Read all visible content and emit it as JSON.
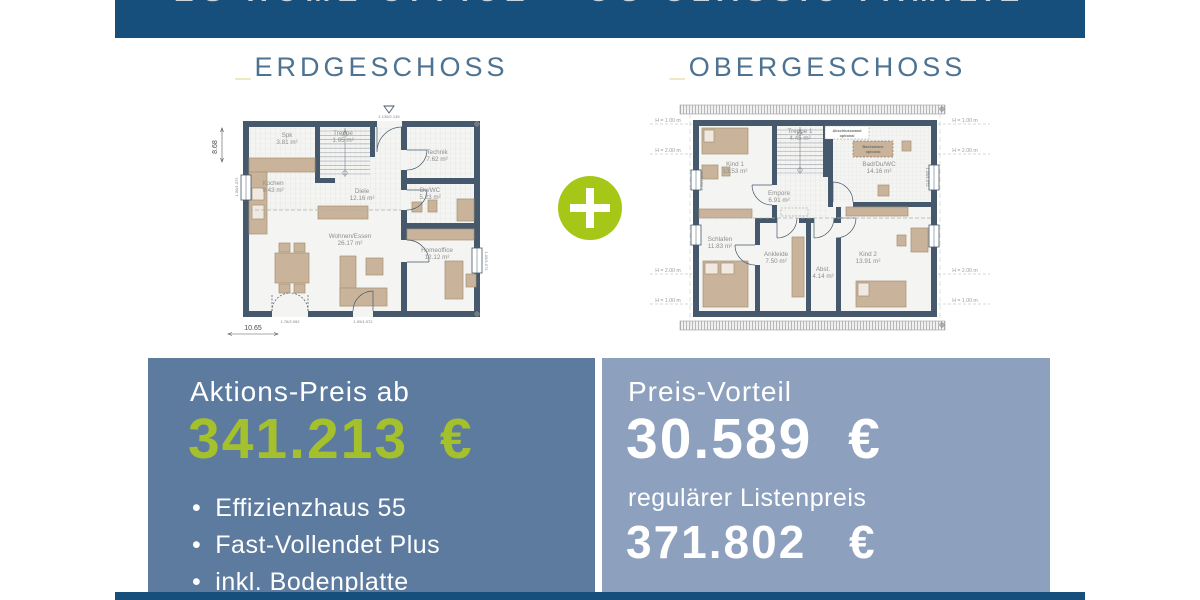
{
  "banner": {
    "title": "EG HOME OFFICE + OG CLASSIC FAMILIE"
  },
  "headings": {
    "underscore": "_",
    "eg_label": "ERDGESCHOSS",
    "og_label": "OBERGESCHOSS"
  },
  "colors": {
    "navy": "#164e7c",
    "box_left": "#5d7b9e",
    "box_right": "#8da0bd",
    "accent_green": "#a6c717",
    "price_green": "#a4c02c",
    "wall": "#46586b"
  },
  "eg": {
    "rooms": {
      "spk": {
        "name": "Spk",
        "area": "3.81 m²"
      },
      "treppe": {
        "name": "Treppe",
        "area": "1.95 m²"
      },
      "technik": {
        "name": "Technik",
        "area": "7.62 m²"
      },
      "kochen": {
        "name": "Kochen",
        "area": "9.43 m²"
      },
      "diele": {
        "name": "Diele",
        "area": "12.16 m²"
      },
      "duwc": {
        "name": "Du/WC",
        "area": "5.23 m²"
      },
      "wohnen": {
        "name": "Wohnen/Essen",
        "area": "26.17 m²"
      },
      "homeoffice": {
        "name": "Homeoffice",
        "area": "12.12 m²"
      }
    },
    "dim_width": "10.65",
    "dim_height": "8.68",
    "entry_size": "1.135/2.135",
    "terrace_door_size": "1.76/2.092",
    "patio_door_size": "1.09/1.072",
    "window_left_size": "1.00/1.072",
    "window_right_size": "1.09/1.072"
  },
  "og": {
    "rooms": {
      "kind1": {
        "name": "Kind 1",
        "area": "13.53 m²"
      },
      "treppe1": {
        "name": "Treppe 1",
        "area": "4.45 m²"
      },
      "bad": {
        "name": "Bad/Du/WC",
        "area": "14.16 m²"
      },
      "empore": {
        "name": "Empore",
        "area": "6.91 m²"
      },
      "schlafen": {
        "name": "Schlafen",
        "area": "11.83 m²"
      },
      "ankleide": {
        "name": "Ankleide",
        "area": "7.50 m²"
      },
      "abst": {
        "name": "Abst.",
        "area": "4.14 m²"
      },
      "kind2": {
        "name": "Kind 2",
        "area": "13.91 m²"
      }
    },
    "note_wall_1": "Abschlusswand",
    "note_wall_2": "optional",
    "note_tub_1": "Badewanne",
    "note_tub_2": "optional",
    "h_low": "H = 1.00 m",
    "h_high": "H = 2.00 m",
    "window_left_size": "1.00/1.072",
    "window_right_size": "1.09/1.072"
  },
  "offer": {
    "label": "Aktions-Preis ab",
    "price": "341.213 €",
    "bullets": [
      "Effizienzhaus 55",
      "Fast-Vollendet Plus",
      "inkl. Bodenplatte"
    ]
  },
  "advantage": {
    "label": "Preis-Vorteil",
    "price": "30.589 €",
    "sub_label": "regulärer Listenpreis",
    "sub_price": "371.802 €"
  }
}
